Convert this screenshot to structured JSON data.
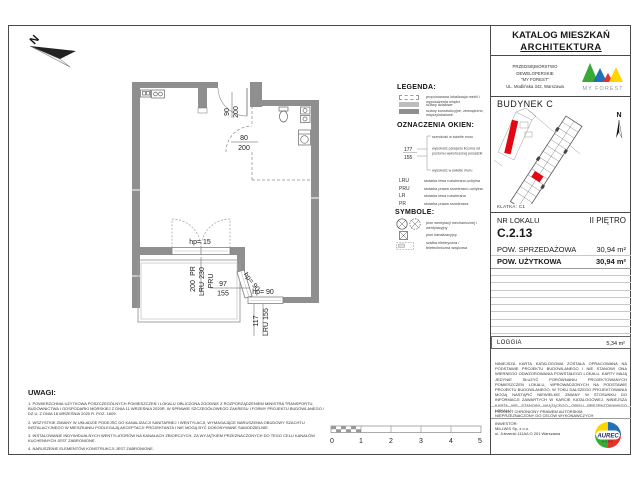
{
  "colors": {
    "wall": "#8f8f8f",
    "highlight_red": "#e30613",
    "logo_green": "#39a935",
    "logo_blue": "#2071b5",
    "logo_red": "#e63329",
    "logo_yellow": "#ffd500",
    "aurec_navy": "#1d2b5e"
  },
  "north": {
    "letter": "N"
  },
  "plan": {
    "labels": {
      "entry_w": "90",
      "entry_h": "200",
      "bath_door_w": "80",
      "bath_door_h": "200",
      "balcony_hp": "hp= 15",
      "pr": "PR",
      "pr_w": "200",
      "h230": "230",
      "lru": "LRU",
      "pru": "PRU",
      "w97": "97",
      "w155": "155",
      "hp90_diag": "hp= 90",
      "hp90": "hp= 90",
      "w117": "117",
      "w155b": "155",
      "lrub": "LRU"
    }
  },
  "legend": {
    "title": "LEGENDA:",
    "items": [
      {
        "label": "proponowana lokalizacja mebli i wyposażenia wnętrz"
      },
      {
        "label": "ściany działowe"
      },
      {
        "label": "ściany konstrukcyjne, zewnętrzne, międzylokalowe"
      }
    ],
    "windows_title": "OZNACZENIA OKIEN:",
    "win": {
      "top": "szerokość w świetle muru",
      "num_top": "177",
      "num_bot": "155",
      "mid1": "wysokość parapetu liczona od",
      "mid2": "poziomu wykończonej posadzki",
      "bottom": "wysokość w świetle muru"
    },
    "types": [
      {
        "code": "LRU",
        "label": "stolarka lewa rozwierano-uchylna"
      },
      {
        "code": "PRU",
        "label": "stolarka prawa rozwierano-uchylna"
      },
      {
        "code": "LR",
        "label": "stolarka lewa rozwierana"
      },
      {
        "code": "PR",
        "label": "stolarka prawa rozwierana"
      }
    ],
    "symbols_title": "SYMBOLE:",
    "symbols": [
      {
        "label": "pion wentylacji mechanicznej i wentylacyjny"
      },
      {
        "label": "pion kanalizacyjny"
      },
      {
        "label": "szafka elektryczna / teletechniczna wnękowa"
      }
    ]
  },
  "uwagi": {
    "title": "UWAGI:",
    "notes": [
      "1. POWIERZCHNIA UŻYTKOWA POSZCZEGÓLNYCH POMIESZCZEŃ I LOKALU OBLICZONA ZGODNIE Z ROZPORZĄDZENIEM MINISTRA TRANSPORTU, BUDOWNICTWA I GOSPODARKI MORSKIEJ Z DNIA 11 WRZEŚNIA 2020R. W SPRAWIE SZCZEGÓŁOWEGO ZAKRESU I FORMY PROJEKTU BUDOWLANEGO / DZ.U. Z DNIA 18 WRZEŚNIA 2020 R. POZ. 1609.",
      "2. WSZYSTKIE ZMIANY W UKŁADZIE PODEJŚĆ DO KANALIZACJI SANITARNEJ I WENTYLACJI, WYMAGAJĄCE NARUSZENIA OBUDOWY SZACHTU INSTALACYJNEGO W MIESZKANIU PODLEGAJĄ AKCEPTACJI PROJEKTANTA I NIE MOGĄ BYĆ DOKONYWANE SAMODZIELNIE.",
      "3. INSTALOWANIE INDYWIDUALNYCH WENTYLATORÓW NA KANAŁACH ZBIORCZYCH, ZA WYJĄTKIEM PRZEZNACZONYCH DO TEGO CELU KANAŁÓW KUCHENNYCH JEST ZABRONIONE.",
      "4. NARUSZENIE ELEMENTÓW KONSTRUKCJI JEST ZABRONIONE."
    ]
  },
  "scalebar": {
    "ticks": [
      "0",
      "1",
      "2",
      "3",
      "4",
      "5"
    ]
  },
  "panel": {
    "title1": "KATALOG MIESZKAŃ",
    "title2": "ARCHITEKTURA",
    "developer": {
      "line1": "PRZEDSIĘBIORSTWO",
      "line2": "DEWELOPERSKIE",
      "line3": "\"MY FOREST\"",
      "line4": "UL. Modlińska 342, Warszawa"
    },
    "brand": "MY FOREST",
    "building": "BUDYNEK C",
    "klatka": "KLATKA: C1",
    "nr_lokalu_label": "NR LOKALU",
    "floor": "II PIĘTRO",
    "unit": "C.2.13",
    "rows": [
      {
        "label": "POW. SPRZEDAŻOWA",
        "value": "30,94 m²"
      },
      {
        "label": "POW. UŻYTKOWA",
        "value": "30,94 m²"
      }
    ],
    "loggia_label": "LOGGIA",
    "loggia_value": "5,34 m²",
    "disclaimer": "NINIEJSZA KARTA KATALOGOWA ZOSTAŁA OPRACOWANA NA PODSTAWIE PROJEKTU BUDOWLANEGO I NIE STANOWI ONA WIERNEGO ODWZOROWANIA POWSTAŁEGO LOKALU. KARTY MAJĄ JEDYNIE SŁUŻYĆ PORÓWNANIU PROJEKTOWANYCH POMIESZCZEŃ LOKALU, WPROWADZONYCH NA PODSTAWIE PROJEKTU BUDOWLANEGO. W TOKU DALSZEGO PROJEKTOWANIA MOGĄ NASTĄPIĆ NIEWIELKIE ZMIANY W STOSUNKU DO INFORMACJI ZAWARTYCH W KARCIE KATALOGOWEJ. NINIEJSZA KARTA NIE STANOWI WIĄŻĄCEGO OPISU PREZENTOWANEGO LOKALU.",
    "copyright1": "PROJEKT CHRONIONY PRAWEM AUTORSKIM",
    "copyright2": "NIEPRZEZNACZONY DO CELÓW WYKONAWCZYCH",
    "investor_label": "INWESTOR:",
    "investor_name": "MILLWIS Sp. z o.o.",
    "investor_addr": "ul. Jutrzenki 111A/LO 201 Warszawa",
    "aurec": "AUREC",
    "aurec_sub": "HOME"
  }
}
